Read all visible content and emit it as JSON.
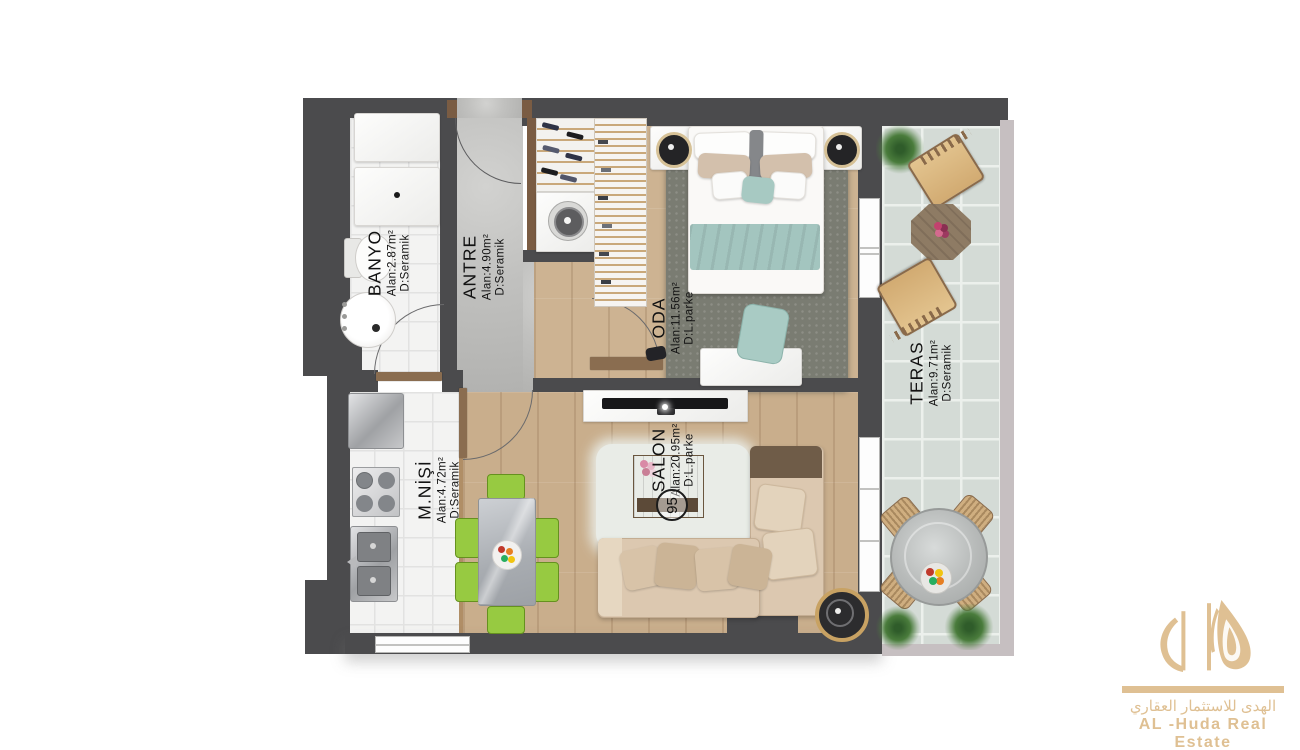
{
  "title": "Apartment floor plan",
  "rooms": {
    "banyo": {
      "name": "BANYO",
      "area": "Alan:2.87m²",
      "floor": "D:Seramik"
    },
    "antre": {
      "name": "ANTRE",
      "area": "Alan:4.90m²",
      "floor": "D:Seramik"
    },
    "oda": {
      "name": "ODA",
      "area": "Alan:11.56m²",
      "floor": "D:L.parke"
    },
    "teras": {
      "name": "TERAS",
      "area": "Alan:9.71m²",
      "floor": "D:Seramik"
    },
    "mnisi": {
      "name": "M.NİŞİ",
      "area": "Alan:4.72m²",
      "floor": "D:Seramik"
    },
    "salon": {
      "name": "SALON",
      "area": "Alan:20.95m²",
      "floor": "D:L.parke"
    }
  },
  "unit_number": "95",
  "logo": {
    "arabic": "الهدى للاستثمار العقاري",
    "english": "AL -Huda Real Estate",
    "color": "#dfc093"
  },
  "colors": {
    "wall": "#4b4b4d",
    "wall_light": "#c6bfc1",
    "wood": "#cbb392",
    "concrete": "#c1c1bf",
    "bath_tile": "#f3f3f2",
    "terrace_tile": "#d4dbd6",
    "accent_green": "#97ca41",
    "accent_teal": "#a3c5bf",
    "sofa_beige": "#dcc8b0",
    "gold": "#dfc093"
  }
}
